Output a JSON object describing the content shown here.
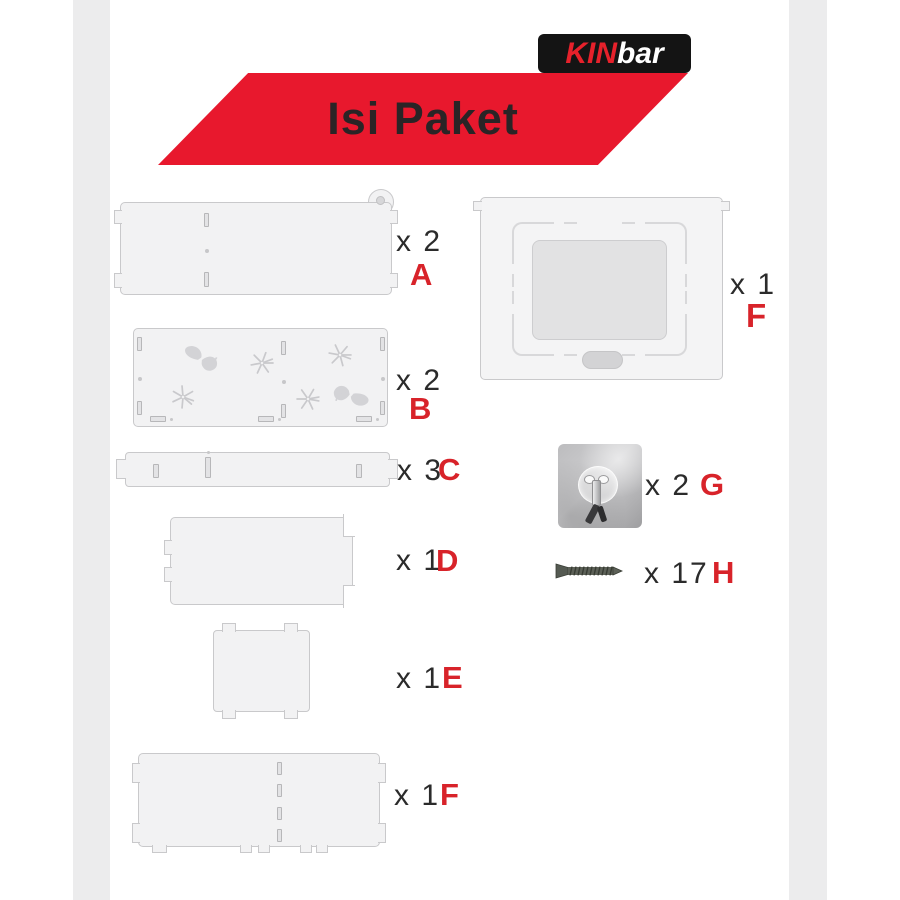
{
  "logo": {
    "kin": "KIN",
    "bar": "bar"
  },
  "banner": {
    "title": "Isi Paket"
  },
  "items": {
    "a": {
      "qty": "x 2",
      "letter": "A"
    },
    "b": {
      "qty": "x 2",
      "letter": "B"
    },
    "c": {
      "qty": "x 3",
      "letter": "C"
    },
    "d": {
      "qty": "x 1",
      "letter": "D"
    },
    "e": {
      "qty": "x 1",
      "letter": "E"
    },
    "f_strip": {
      "qty": "x 1",
      "letter": "F"
    },
    "f_panel": {
      "qty": "x 1",
      "letter": "F"
    },
    "g": {
      "qty": "x 2",
      "letter": "G"
    },
    "h": {
      "qty": "x 17",
      "letter": "H"
    }
  },
  "colors": {
    "banner_red": "#e8182d",
    "letter_red": "#d8232a",
    "logo_black": "#141414",
    "panel_fill": "#f2f2f3",
    "panel_border": "#c9c9cb"
  },
  "icons": {
    "butterfly": "butterfly-cutout",
    "sparkle": "sparkle-cutout",
    "hook": "adhesive-hook-photo",
    "screw": "screw-side-view"
  }
}
